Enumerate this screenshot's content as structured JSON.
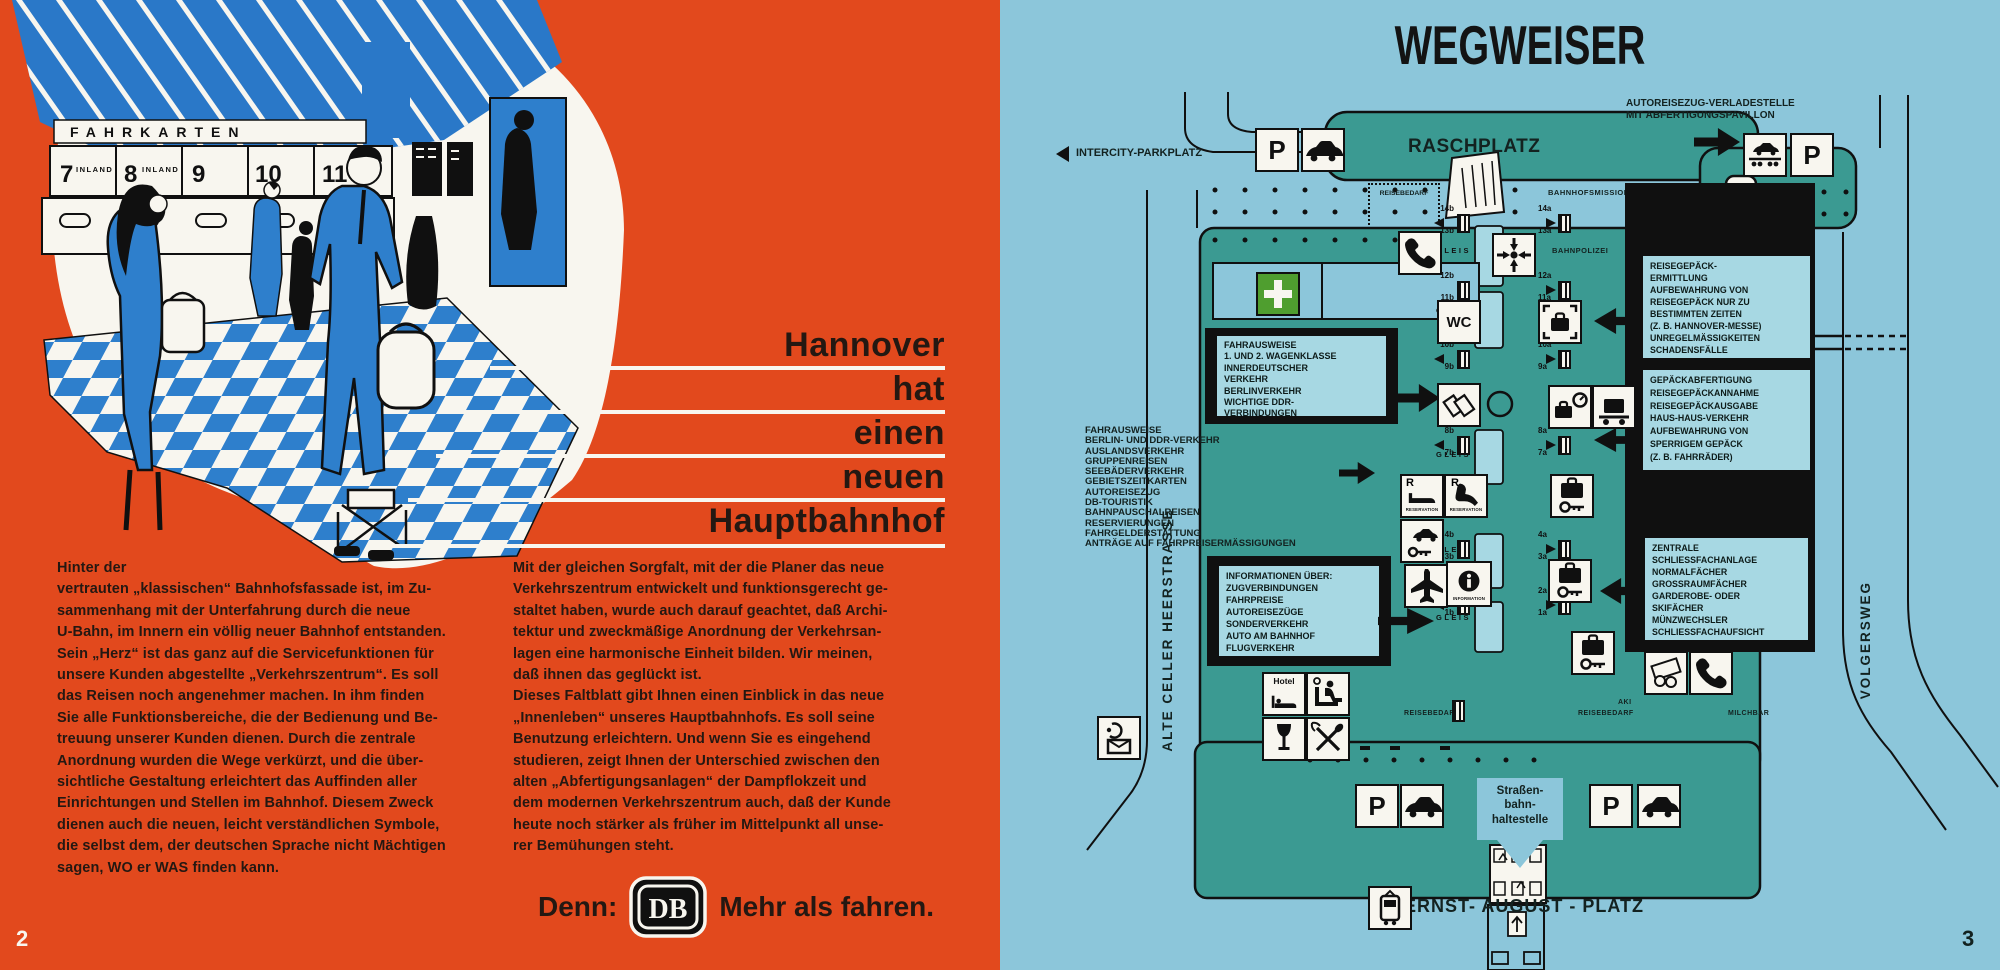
{
  "colors": {
    "orange": "#e2491d",
    "page_blue": "#8cc6da",
    "teal": "#3b9a92",
    "black": "#101010",
    "panel_blue": "#a7d8e3",
    "accent_blue": "#2e7fcc",
    "cream": "#f8f6ef",
    "green_cross": "#4f9e2f"
  },
  "left_page": {
    "page_number": "2",
    "illustration": {
      "sign": "FAHRKARTEN",
      "counter_1": "7",
      "counter_1_sub": "INLAND",
      "counter_2": "8",
      "counter_2_sub": "INLAND",
      "counter_3": "9",
      "counter_4": "10",
      "counter_5": "11"
    },
    "title_lines": [
      "Hannover",
      "hat",
      "einen",
      "neuen",
      "Hauptbahnhof"
    ],
    "body_col1": "Hinter der\nvertrauten „klassischen“ Bahnhofsfassade ist, im Zu-\nsammenhang mit der Unterfahrung durch die neue\nU-Bahn, im Innern ein völlig neuer Bahnhof entstanden.\nSein „Herz“ ist das ganz auf die Servicefunktionen für\nunsere Kunden abgestellte „Verkehrszentrum“. Es soll\ndas Reisen noch angenehmer machen. In ihm finden\nSie alle Funktionsbereiche, die der Bedienung und Be-\ntreuung unserer Kunden dienen. Durch die zentrale\nAnordnung wurden die Wege verkürzt, und die über-\nsichtliche Gestaltung erleichtert das Auffinden aller\nEinrichtungen und Stellen im Bahnhof. Diesem Zweck\ndienen auch die neuen, leicht verständlichen Symbole,\ndie selbst dem, der deutschen Sprache nicht Mächtigen\nsagen, WO er WAS finden kann.",
    "body_col2": "Mit der gleichen Sorgfalt, mit der die Planer das neue\nVerkehrszentrum entwickelt und funktionsgerecht ge-\nstaltet haben, wurde auch darauf geachtet, daß Archi-\ntektur und zweckmäßige Anordnung der Verkehrsan-\nlagen eine harmonische Einheit bilden. Wir meinen,\ndaß ihnen das geglückt ist.\nDieses Faltblatt gibt Ihnen einen Einblick in das neue\n„Innenleben“ unseres Hauptbahnhofs. Es soll seine\nBenutzung erleichtern. Und wenn Sie es eingehend\nstudieren, zeigt Ihnen der Unterschied zwischen den\nalten „Abfertigungsanlagen“ der Dampflokzeit und\ndem modernen Verkehrszentrum auch, daß der Kunde\nheute noch stärker als früher im Mittelpunkt all unse-\nrer Bemühungen steht.",
    "slogan_prefix": "Denn:",
    "logo_text": "DB",
    "slogan_suffix": "Mehr als fahren."
  },
  "right_page": {
    "page_number": "3",
    "title": "WEGWEISER",
    "labels": {
      "raschplatz": "RASCHPLATZ",
      "ernst_august_platz": "ERNST- AUGUST - PLATZ",
      "alte_celler_heerstrasse": "ALTE  CELLER  HEERSTRASSE",
      "volgersweg": "VOLGERSWEG",
      "intercity_parkplatz": "INTERCITY-PARKPLATZ",
      "autoreisezug": "AUTOREISEZUG-VERLADESTELLE\nMIT ABFERTIGUNGSPAVILLON",
      "tram_stop": "Straßen-\nbahn-\nhaltestelle",
      "bahnhofsmission": "BAHNHOFSMISSION",
      "bahnpolizei": "BAHNPOLIZEI",
      "reisebedarf": "REISEBEDARF",
      "imbiss": "IMBISS",
      "rto": "RTO",
      "milchbar": "MILCHBAR",
      "aki": "AKI",
      "gleis": "GLEIS",
      "wc": "WC",
      "hotel": "Hotel",
      "p": "P",
      "r": "R",
      "reservation": "RESERVATION",
      "information": "INFORMATION"
    },
    "service_boxes": {
      "fahrausweise_innerdeutsch": "FAHRAUSWEISE\n1. UND 2. WAGENKLASSE\nINNERDEUTSCHER\nVERKEHR\nBERLINVERKEHR\nWICHTIGE DDR-\nVERBINDUNGEN",
      "fahrausweise_list": "FAHRAUSWEISE\nBERLIN- UND DDR-VERKEHR\nAUSLANDSVERKEHR\nGRUPPENREISEN\nSEEBÄDERVERKEHR\nGEBIETSZEITKARTEN\nAUTOREISEZUG\nDB-TOURISTIK\nBAHNPAUSCHALREISEN\nRESERVIERUNGEN\nFAHRGELDERSTATTUNG\nANTRÄGE AUF FAHRPREISERMÄSSIGUNGEN",
      "informationen": "INFORMATIONEN ÜBER:\nZUGVERBINDUNGEN\nFAHRPREISE\nAUTOREISEZÜGE\nSONDERVERKEHR\nAUTO AM BAHNHOF\nFLUGVERKEHR",
      "reisegepaeck": "REISEGEPÄCK-\nERMITTLUNG\nAUFBEWAHRUNG VON\nREISEGEPÄCK NUR ZU\nBESTIMMTEN ZEITEN\n(Z. B. HANNOVER-MESSE)\nUNREGELMÄSSIGKEITEN\nSCHADENSFÄLLE",
      "gepaeckabfertigung": "GEPÄCKABFERTIGUNG\nREISEGEPÄCKANNAHME\nREISEGEPÄCKAUSGABE\nHAUS-HAUS-VERKEHR\nAUFBEWAHRUNG VON\nSPERRIGEM GEPÄCK\n(Z. B. FAHRRÄDER)",
      "schliessfach": "ZENTRALE\nSCHLIESSFACHANLAGE\nNORMALFÄCHER\nGROSSRAUMFÄCHER\nGARDEROBE- ODER\nSKIFÄCHER\nMÜNZWECHSLER\nSCHLIESSFACHAUFSICHT"
    },
    "platforms_left": [
      "14b",
      "13b",
      "12b",
      "11b",
      "10b",
      "9b",
      "8b",
      "7b",
      "4b",
      "3b",
      "2b",
      "1b"
    ],
    "platforms_right": [
      "14a",
      "13a",
      "12a",
      "11a",
      "10a",
      "9a",
      "8a",
      "7a",
      "4a",
      "3a",
      "2a",
      "1a"
    ]
  }
}
